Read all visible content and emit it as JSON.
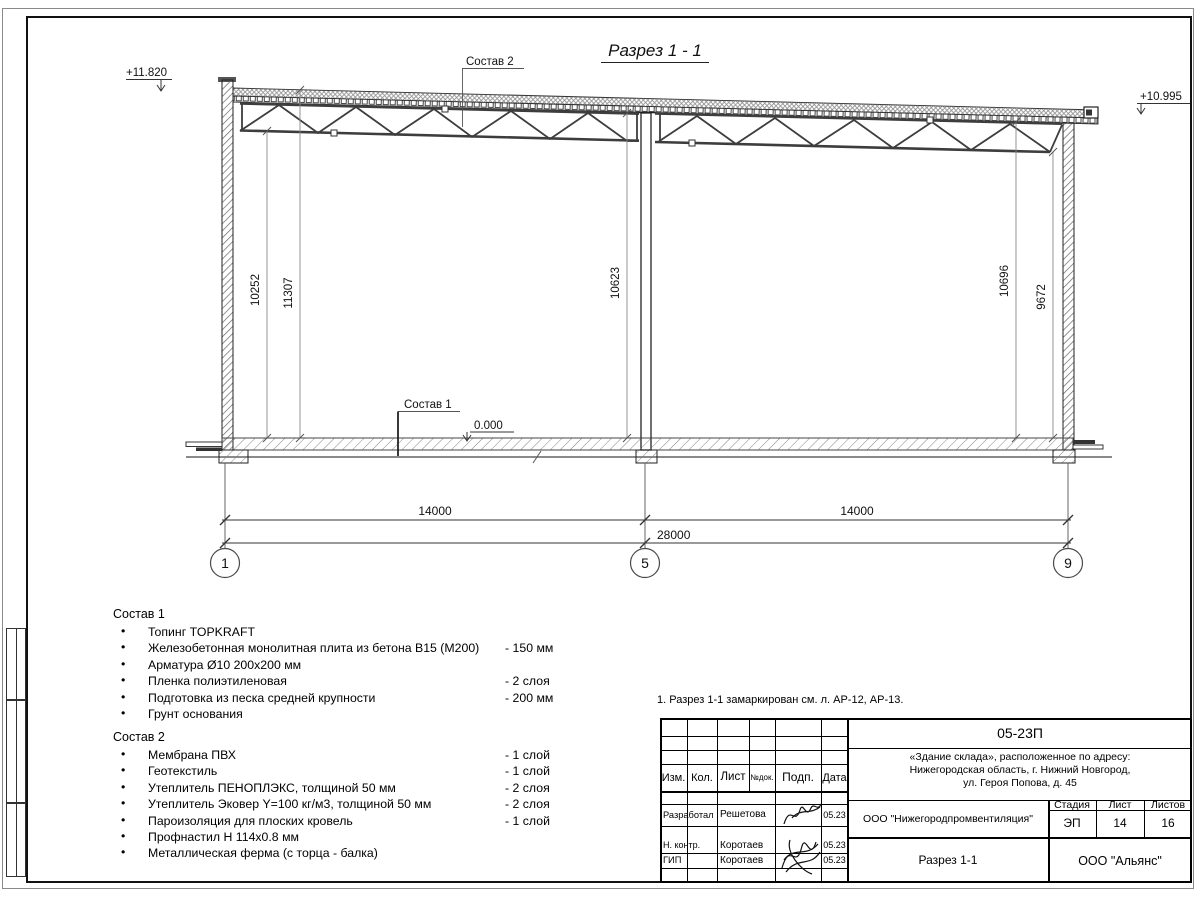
{
  "drawing": {
    "title": "Разрез 1 - 1",
    "elevation_left": "+11.820",
    "elevation_right": "+10.995",
    "elevation_floor": "0.000",
    "label_sostav1": "Состав 1",
    "label_sostav2": "Состав 2",
    "dim_v1": "10252",
    "dim_v2": "11307",
    "dim_v3": "10623",
    "dim_v4": "10696",
    "dim_v5": "9672",
    "dim_span1": "14000",
    "dim_span2": "14000",
    "dim_total": "28000",
    "axis1": "1",
    "axis2": "5",
    "axis3": "9"
  },
  "sostav1": {
    "heading": "Состав 1",
    "items": [
      {
        "text": "Топинг TOPKRAFT",
        "value": ""
      },
      {
        "text": "Железобетонная монолитная плита из бетона В15 (М200)",
        "value": "-  150 мм"
      },
      {
        "text": "Арматура Ø10 200х200 мм",
        "value": ""
      },
      {
        "text": "Пленка полиэтиленовая",
        "value": "-  2 слоя"
      },
      {
        "text": "Подготовка из песка средней крупности",
        "value": "- 200 мм"
      },
      {
        "text": "Грунт основания",
        "value": ""
      }
    ]
  },
  "sostav2": {
    "heading": "Состав 2",
    "items": [
      {
        "text": "Мембрана ПВХ",
        "value": "- 1 слой"
      },
      {
        "text": "Геотекстиль",
        "value": "- 1 слой"
      },
      {
        "text": "Утеплитель ПЕНОПЛЭКС, толщиной 50 мм",
        "value": "- 2 слоя"
      },
      {
        "text": "Утеплитель Эковер Y=100 кг/м3, толщиной 50 мм",
        "value": "- 2 слоя"
      },
      {
        "text": "Пароизоляция для плоских кровель",
        "value": "- 1 слой"
      },
      {
        "text": "Профнастил Н 114х0.8 мм",
        "value": ""
      },
      {
        "text": "Металлическая ферма (с торца - балка)",
        "value": ""
      }
    ]
  },
  "note": "1. Разрез 1-1 замаркирован см. л. АР-12, АР-13.",
  "titleblock": {
    "code": "05-23П",
    "project_line1": "«Здание склада», расположенное по адресу:",
    "project_line2": "Нижегородская область, г. Нижний Новгород,",
    "project_line3": "ул. Героя Попова, д. 45",
    "col_izm": "Изм.",
    "col_kol": "Кол.",
    "col_list": "Лист",
    "col_ndok": "№док.",
    "col_podp": "Подп.",
    "col_data": "Дата",
    "row1_role": "Разработал",
    "row1_name": "Решетова",
    "row1_date": "05.23",
    "row2_role": "Н. контр.",
    "row2_name": "Коротаев",
    "row2_date": "05.23",
    "row3_role": "ГИП",
    "row3_name": "Коротаев",
    "row3_date": "05.23",
    "company": "ООО \"Нижегородпромвентиляция\"",
    "stage_label": "Стадия",
    "sheet_label": "Лист",
    "sheets_label": "Листов",
    "stage_value": "ЭП",
    "sheet_value": "14",
    "sheets_value": "16",
    "drawing_name": "Разрез 1-1",
    "firm": "ООО \"Альянс\""
  }
}
